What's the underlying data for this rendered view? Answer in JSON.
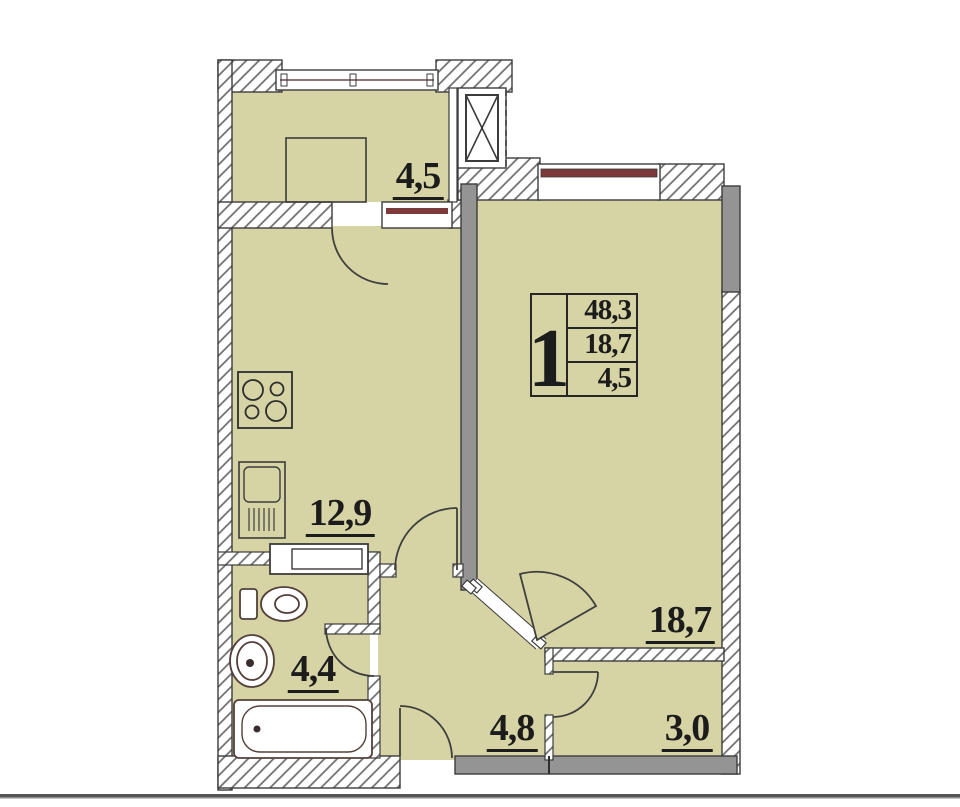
{
  "legend": {
    "room_count": "1",
    "values": [
      "48,3",
      "18,7",
      "4,5"
    ]
  },
  "rooms": {
    "balcony": "4,5",
    "kitchen": "12,9",
    "bathroom": "4,4",
    "hallway": "4,8",
    "storage": "3,0",
    "living": "18,7"
  },
  "colors": {
    "room_fill": "#d6d3a4",
    "wall_gray": "#949494",
    "window_accent": "#7d3a3a",
    "line": "#3c3c3c",
    "text": "#1c1c1c"
  }
}
